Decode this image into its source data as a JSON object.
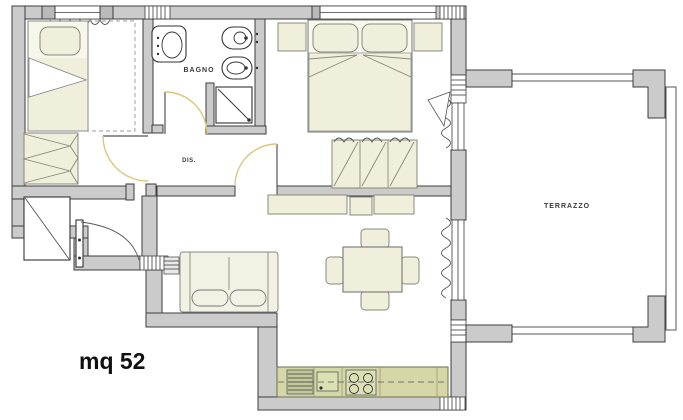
{
  "plan": {
    "type": "apartment-floor-plan",
    "area_label": "mq 52",
    "rooms": {
      "bathroom": {
        "label": "BAGNO"
      },
      "hallway": {
        "label": "DIS."
      },
      "terrace": {
        "label": "TERRAZZO"
      }
    }
  },
  "colors": {
    "background": "#ffffff",
    "wall_fill": "#cbcbcb",
    "wall_stroke": "#3c3c3c",
    "furniture_fill": "#efefdc",
    "furniture_stroke": "#8a8a78",
    "kitchen_counter_fill": "#d5d7a6",
    "door_swing": "#d9c87c",
    "room_label_text": "#3a3a3a",
    "area_label_text": "#111111"
  }
}
